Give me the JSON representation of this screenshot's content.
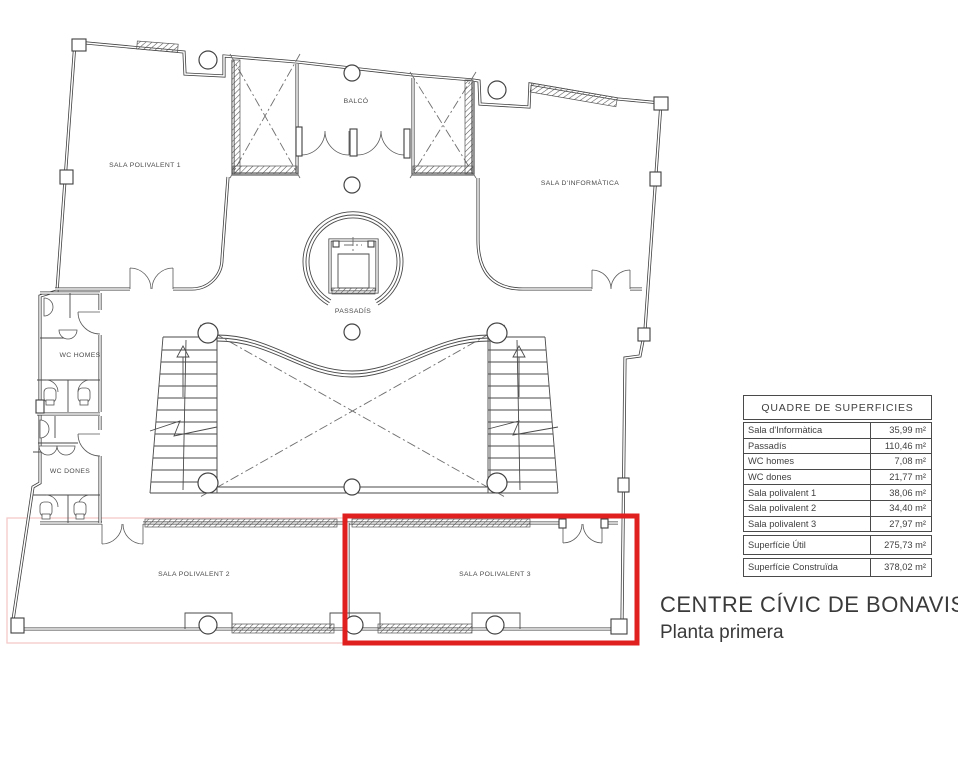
{
  "plan": {
    "labels": {
      "sala1": "SALA POLIVALENT 1",
      "informatica": "SALA D'INFORMÀTICA",
      "balco": "BALCÓ",
      "passadis": "PASSADÍS",
      "wc_homes": "WC HOMES",
      "wc_dones": "WC DONES",
      "sala2": "SALA POLIVALENT 2",
      "sala3": "SALA POLIVALENT 3"
    },
    "highlight": {
      "room": "SALA POLIVALENT 3",
      "color": "#e01f1f"
    }
  },
  "table": {
    "title": "QUADRE DE SUPERFICIES",
    "rows": [
      {
        "label": "Sala d'Informàtica",
        "value": "35,99 m²"
      },
      {
        "label": "Passadís",
        "value": "110,46 m²"
      },
      {
        "label": "WC homes",
        "value": "7,08 m²"
      },
      {
        "label": "WC dones",
        "value": "21,77 m²"
      },
      {
        "label": "Sala polivalent 1",
        "value": "38,06 m²"
      },
      {
        "label": "Sala polivalent 2",
        "value": "34,40 m²"
      },
      {
        "label": "Sala polivalent 3",
        "value": "27,97 m²"
      }
    ],
    "summary": [
      {
        "label": "Superfície Útil",
        "value": "275,73 m²"
      },
      {
        "label": "Superfície Construïda",
        "value": "378,02 m²"
      }
    ]
  },
  "title": {
    "line1": "CENTRE CÍVIC DE BONAVISTA",
    "line2": "Planta primera"
  }
}
